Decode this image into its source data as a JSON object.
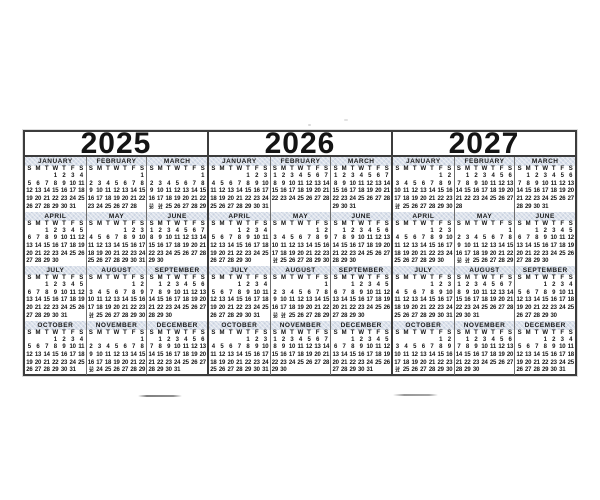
{
  "colors": {
    "paper": "#ffffff",
    "ink": "#161616",
    "grid": "#3c3c3c",
    "month_line": "#6e6e6e",
    "band": "#d9dfe9",
    "smudge": "#8f8f8f"
  },
  "dow": [
    "S",
    "M",
    "T",
    "W",
    "T",
    "F",
    "S"
  ],
  "years": [
    {
      "label": "2025",
      "months": [
        {
          "name": "JANUARY",
          "weeks": [
            "- - - 1 2 3 4",
            "5 6 7 8 9 10 11",
            "12 13 14 15 16 17 18",
            "19 20 21 22 23 24 25",
            "26 27 28 29 30 31 -"
          ]
        },
        {
          "name": "FEBRUARY",
          "weeks": [
            "- - - - - - 1",
            "2 3 4 5 6 7 8",
            "9 10 11 12 13 14 15",
            "16 17 18 19 20 21 22",
            "23 24 25 26 27 28 -"
          ]
        },
        {
          "name": "MARCH",
          "weeks": [
            "- - - - - - 1",
            "2 3 4 5 6 7 8",
            "9 10 11 12 13 14 15",
            "16 17 18 19 20 21 22",
            "23/30 24/31 25 26 27 28 29"
          ]
        },
        {
          "name": "APRIL",
          "weeks": [
            "- - 1 2 3 4 5",
            "6 7 8 9 10 11 12",
            "13 14 15 16 17 18 19",
            "20 21 22 23 24 25 26",
            "27 28 29 30 - - -"
          ]
        },
        {
          "name": "MAY",
          "weeks": [
            "- - - - 1 2 3",
            "4 5 6 7 8 9 10",
            "11 12 13 14 15 16 17",
            "18 19 20 21 22 23 24",
            "25 26 27 28 29 30 31"
          ]
        },
        {
          "name": "JUNE",
          "weeks": [
            "1 2 3 4 5 6 7",
            "8 9 10 11 12 13 14",
            "15 16 17 18 19 20 21",
            "22 23 24 25 26 27 28",
            "29 30 - - - - -"
          ]
        },
        {
          "name": "JULY",
          "weeks": [
            "- - 1 2 3 4 5",
            "6 7 8 9 10 11 12",
            "13 14 15 16 17 18 19",
            "20 21 22 23 24 25 26",
            "27 28 29 30 31 - -"
          ]
        },
        {
          "name": "AUGUST",
          "weeks": [
            "- - - - - 1 2",
            "3 4 5 6 7 8 9",
            "10 11 12 13 14 15 16",
            "17 18 19 20 21 22 23",
            "24/31 25 26 27 28 29 30"
          ]
        },
        {
          "name": "SEPTEMBER",
          "weeks": [
            "- 1 2 3 4 5 6",
            "7 8 9 10 11 12 13",
            "14 15 16 17 18 19 20",
            "21 22 23 24 25 26 27",
            "28 29 30 - - - -"
          ]
        },
        {
          "name": "OCTOBER",
          "weeks": [
            "- - - 1 2 3 4",
            "5 6 7 8 9 10 11",
            "12 13 14 15 16 17 18",
            "19 20 21 22 23 24 25",
            "26 27 28 29 30 31 -"
          ]
        },
        {
          "name": "NOVEMBER",
          "weeks": [
            "- - - - - - 1",
            "2 3 4 5 6 7 8",
            "9 10 11 12 13 14 15",
            "16 17 18 19 20 21 22",
            "23/30 24 25 26 27 28 29"
          ]
        },
        {
          "name": "DECEMBER",
          "weeks": [
            "- 1 2 3 4 5 6",
            "7 8 9 10 11 12 13",
            "14 15 16 17 18 19 20",
            "21 22 23 24 25 26 27",
            "28 29 30 31 - - -"
          ]
        }
      ]
    },
    {
      "label": "2026",
      "months": [
        {
          "name": "JANUARY",
          "weeks": [
            "- - - - 1 2 3",
            "4 5 6 7 8 9 10",
            "11 12 13 14 15 16 17",
            "18 19 20 21 22 23 24",
            "25 26 27 28 29 30 31"
          ]
        },
        {
          "name": "FEBRUARY",
          "weeks": [
            "1 2 3 4 5 6 7",
            "8 9 10 11 12 13 14",
            "15 16 17 18 19 20 21",
            "22 23 24 25 26 27 28",
            "- - - - - - -"
          ]
        },
        {
          "name": "MARCH",
          "weeks": [
            "1 2 3 4 5 6 7",
            "8 9 10 11 12 13 14",
            "15 16 17 18 19 20 21",
            "22 23 24 25 26 27 28",
            "29 30 31 - - - -"
          ]
        },
        {
          "name": "APRIL",
          "weeks": [
            "- - - 1 2 3 4",
            "5 6 7 8 9 10 11",
            "12 13 14 15 16 17 18",
            "19 20 21 22 23 24 25",
            "26 27 28 29 30 - -"
          ]
        },
        {
          "name": "MAY",
          "weeks": [
            "- - - - - 1 2",
            "3 4 5 6 7 8 9",
            "10 11 12 13 14 15 16",
            "17 18 19 20 21 22 23",
            "24/31 25 26 27 28 29 30"
          ]
        },
        {
          "name": "JUNE",
          "weeks": [
            "- 1 2 3 4 5 6",
            "7 8 9 10 11 12 13",
            "14 15 16 17 18 19 20",
            "21 22 23 24 25 26 27",
            "28 29 30 - - - -"
          ]
        },
        {
          "name": "JULY",
          "weeks": [
            "- - - 1 2 3 4",
            "5 6 7 8 9 10 11",
            "12 13 14 15 16 17 18",
            "19 20 21 22 23 24 25",
            "26 27 28 29 30 31 -"
          ]
        },
        {
          "name": "AUGUST",
          "weeks": [
            "- - - - - - 1",
            "2 3 4 5 6 7 8",
            "9 10 11 12 13 14 15",
            "16 17 18 19 20 21 22",
            "23/30 24/31 25 26 27 28 29"
          ]
        },
        {
          "name": "SEPTEMBER",
          "weeks": [
            "- - 1 2 3 4 5",
            "6 7 8 9 10 11 12",
            "13 14 15 16 17 18 19",
            "20 21 22 23 24 25 26",
            "27 28 29 30 - - -"
          ]
        },
        {
          "name": "OCTOBER",
          "weeks": [
            "- - - - 1 2 3",
            "4 5 6 7 8 9 10",
            "11 12 13 14 15 16 17",
            "18 19 20 21 22 23 24",
            "25 26 27 28 29 30 31"
          ]
        },
        {
          "name": "NOVEMBER",
          "weeks": [
            "1 2 3 4 5 6 7",
            "8 9 10 11 12 13 14",
            "15 16 17 18 19 20 21",
            "22 23 24 25 26 27 28",
            "29 30 - - - - -"
          ]
        },
        {
          "name": "DECEMBER",
          "weeks": [
            "- - 1 2 3 4 5",
            "6 7 8 9 10 11 12",
            "13 14 15 16 17 18 19",
            "20 21 22 23 24 25 26",
            "27 28 29 30 31 - -"
          ]
        }
      ]
    },
    {
      "label": "2027",
      "months": [
        {
          "name": "JANUARY",
          "weeks": [
            "- - - - - 1 2",
            "3 4 5 6 7 8 9",
            "10 11 12 13 14 15 16",
            "17 18 19 20 21 22 23",
            "24/31 25 26 27 28 29 30"
          ]
        },
        {
          "name": "FEBRUARY",
          "weeks": [
            "- 1 2 3 4 5 6",
            "7 8 9 10 11 12 13",
            "14 15 16 17 18 19 20",
            "21 22 23 24 25 26 27",
            "28 - - - - - -"
          ]
        },
        {
          "name": "MARCH",
          "weeks": [
            "- 1 2 3 4 5 6",
            "7 8 9 10 11 12 13",
            "14 15 16 17 18 19 20",
            "21 22 23 24 25 26 27",
            "28 29 30 31 - - -"
          ]
        },
        {
          "name": "APRIL",
          "weeks": [
            "- - - - 1 2 3",
            "4 5 6 7 8 9 10",
            "11 12 13 14 15 16 17",
            "18 19 20 21 22 23 24",
            "25 26 27 28 29 30 -"
          ]
        },
        {
          "name": "MAY",
          "weeks": [
            "- - - - - - 1",
            "2 3 4 5 6 7 8",
            "9 10 11 12 13 14 15",
            "16 17 18 19 20 21 22",
            "23/30 24/31 25 26 27 28 29"
          ]
        },
        {
          "name": "JUNE",
          "weeks": [
            "- - 1 2 3 4 5",
            "6 7 8 9 10 11 12",
            "13 14 15 16 17 18 19",
            "20 21 22 23 24 25 26",
            "27 28 29 30 - - -"
          ]
        },
        {
          "name": "JULY",
          "weeks": [
            "- - - - 1 2 3",
            "4 5 6 7 8 9 10",
            "11 12 13 14 15 16 17",
            "18 19 20 21 22 23 24",
            "25 26 27 28 29 30 31"
          ]
        },
        {
          "name": "AUGUST",
          "weeks": [
            "1 2 3 4 5 6 7",
            "8 9 10 11 12 13 14",
            "15 16 17 18 19 20 21",
            "22 23 24 25 26 27 28",
            "29 30 31 - - - -"
          ]
        },
        {
          "name": "SEPTEMBER",
          "weeks": [
            "- - - 1 2 3 4",
            "5 6 7 8 9 10 11",
            "12 13 14 15 16 17 18",
            "19 20 21 22 23 24 25",
            "26 27 28 29 30 - -"
          ]
        },
        {
          "name": "OCTOBER",
          "weeks": [
            "- - - - - 1 2",
            "3 4 5 6 7 8 9",
            "10 11 12 13 14 15 16",
            "17 18 19 20 21 22 23",
            "24/31 25 26 27 28 29 30"
          ]
        },
        {
          "name": "NOVEMBER",
          "weeks": [
            "- 1 2 3 4 5 6",
            "7 8 9 10 11 12 13",
            "14 15 16 17 18 19 20",
            "21 22 23 24 25 26 27",
            "28 29 30 - - - -"
          ]
        },
        {
          "name": "DECEMBER",
          "weeks": [
            "- - - 1 2 3 4",
            "5 6 7 8 9 10 11",
            "12 13 14 15 16 17 18",
            "19 20 21 22 23 24 25",
            "26 27 28 29 30 31 -"
          ]
        }
      ]
    }
  ]
}
